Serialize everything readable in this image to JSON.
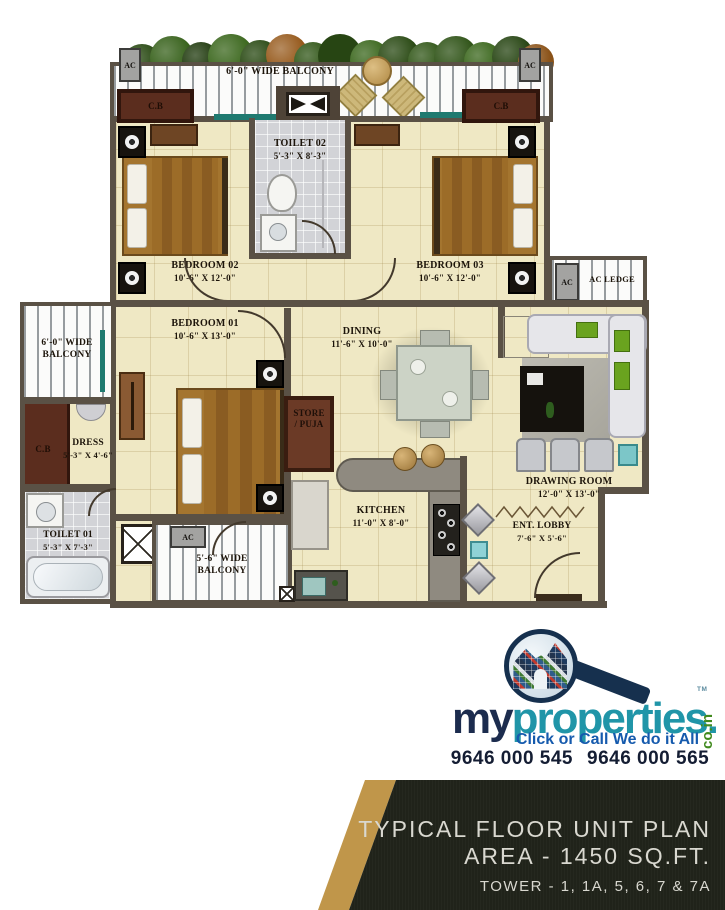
{
  "plan": {
    "ac": "AC",
    "cb": "C.B",
    "ac_ledge": "AC LEDGE",
    "balcony_top": {
      "label": "6'-0\" WIDE BALCONY"
    },
    "balcony_left": {
      "line1": "6'-0\" WIDE",
      "line2": "BALCONY"
    },
    "balcony_bottom": {
      "line1": "5'-6\" WIDE",
      "line2": "BALCONY"
    },
    "toilet2": {
      "name": "TOILET 02",
      "dims": "5'-3\" X 8'-3\""
    },
    "bedroom2": {
      "name": "BEDROOM 02",
      "dims": "10'-6\" X 12'-0\""
    },
    "bedroom3": {
      "name": "BEDROOM 03",
      "dims": "10'-6\" X 12'-0\""
    },
    "bedroom1": {
      "name": "BEDROOM 01",
      "dims": "10'-6\" X 13'-0\""
    },
    "dining": {
      "name": "DINING",
      "dims": "11'-6\" X 10'-0\""
    },
    "kitchen": {
      "name": "KITCHEN",
      "dims": "11'-0\" X 8'-0\""
    },
    "drawing": {
      "name": "DRAWING ROOM",
      "dims": "12'-0\" X 13'-0\""
    },
    "lobby": {
      "name": "ENT. LOBBY",
      "dims": "7'-6\" X 5'-6\""
    },
    "dress": {
      "name": "DRESS",
      "dims": "5'-3\" X 4'-6\""
    },
    "toilet1": {
      "name": "TOILET 01",
      "dims": "5'-3\" X 7'-3\""
    },
    "store": {
      "line1": "STORE",
      "line2": "/ PUJA"
    }
  },
  "brand": {
    "name_part1": "my",
    "name_part2": "properties.",
    "tld": "co.in",
    "tm": "TM",
    "tagline": "Click or Call We do it All",
    "phone1": "9646 000 545",
    "phone2": "9646 000 565"
  },
  "footer": {
    "title": "TYPICAL FLOOR UNIT PLAN",
    "area": "AREA - 1450 SQ.FT.",
    "towers": "TOWER - 1, 1A, 5, 6, 7 & 7A"
  },
  "colors": {
    "wall": "#5a5145",
    "floor": "#efe8c4",
    "tile": "#d2d3d7",
    "brand_navy": "#16304e",
    "brand_teal": "#2095a8",
    "brand_green": "#418a1e",
    "brand_blue": "#155aad",
    "gold": "#c0964a",
    "footer_bg": "#20231a"
  }
}
